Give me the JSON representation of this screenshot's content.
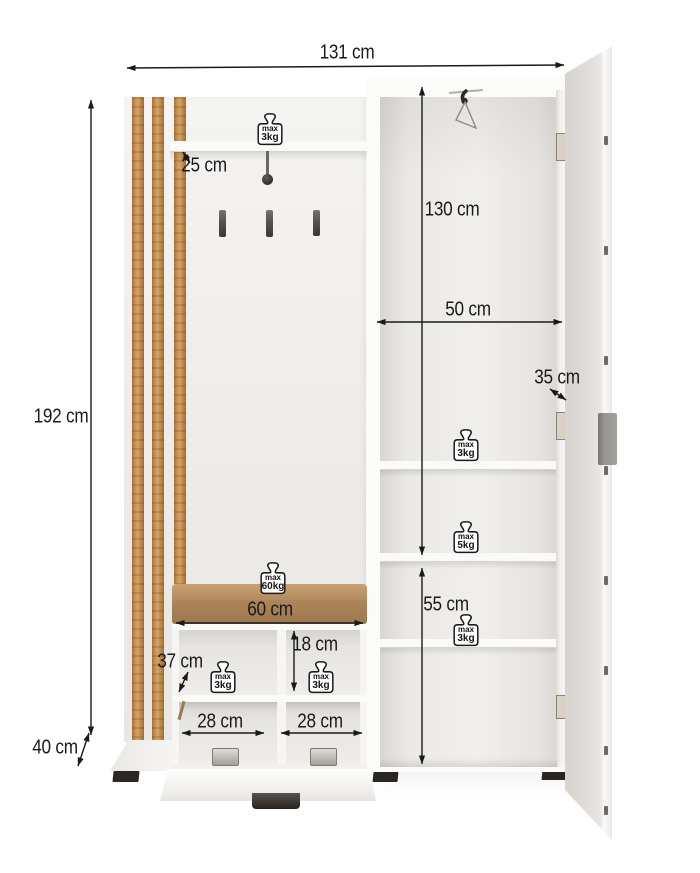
{
  "figure": {
    "caption": "",
    "colors": {
      "background": "#ffffff",
      "wood_slat": "#c18a4d",
      "cushion_top": "#c09a6c",
      "cushion_front": "#a8825a",
      "dimension_ink": "#1a1a1a",
      "feet": "#2b2724",
      "door_handle": "#989693"
    },
    "icons": {
      "load_limit": "weight-icon",
      "hanger": "clothes-hanger-icon"
    }
  },
  "dimensions": {
    "total_width": "131 cm",
    "total_height": "192 cm",
    "base_depth": "40 cm",
    "top_shelf_depth": "25 cm",
    "wardrobe_interior_height": "130 cm",
    "wardrobe_width": "50 cm",
    "wardrobe_depth": "35 cm",
    "lower_shelves_height": "55 cm",
    "bench_width": "60 cm",
    "bench_niche_height": "18 cm",
    "bench_niche_depth": "37 cm",
    "shoe_niche_left_width": "28 cm",
    "shoe_niche_right_width": "28 cm"
  },
  "load_limits": {
    "top_shelf": {
      "line1": "max",
      "line2": "3kg"
    },
    "wardrobe_shelf_upper": {
      "line1": "max",
      "line2": "3kg"
    },
    "wardrobe_shelf_middle": {
      "line1": "max",
      "line2": "5kg"
    },
    "wardrobe_shelf_lower": {
      "line1": "max",
      "line2": "3kg"
    },
    "bench_seat": {
      "line1": "max",
      "line2": "60kg"
    },
    "bench_niche_left": {
      "line1": "max",
      "line2": "3kg"
    },
    "bench_niche_right": {
      "line1": "max",
      "line2": "3kg"
    }
  }
}
